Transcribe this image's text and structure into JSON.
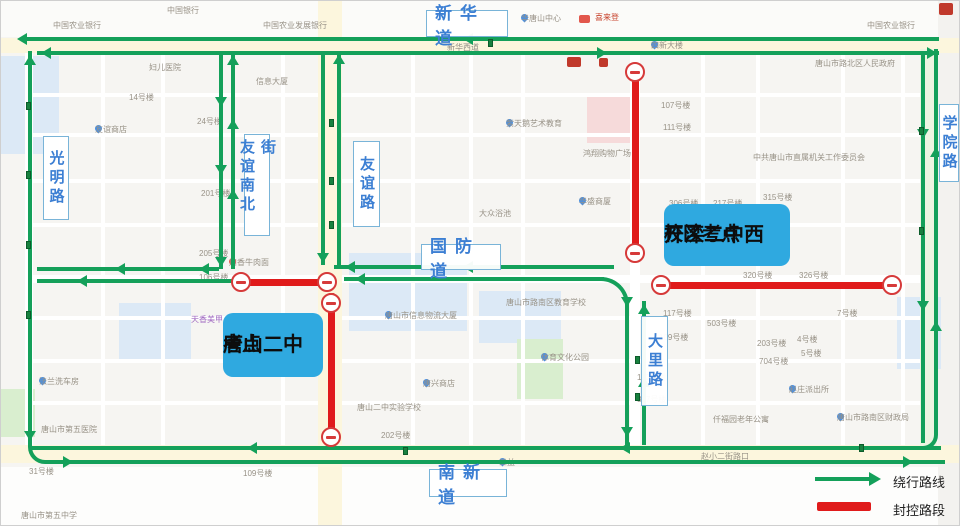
{
  "road_labels": {
    "xinhuadao": "新华道",
    "xueyuanlu": "学院路",
    "guangminglu": "光明路",
    "youyi_nanbei_jie": "友谊南北街",
    "youyilu": "友谊路",
    "guofangdao": "国防道",
    "dalilu": "大里路",
    "nanxindao": "南新道"
  },
  "exam_sites": {
    "tangshan_no2": {
      "line1": "唐山二中",
      "line2": "考点"
    },
    "kailuan_no2_west": {
      "line1": "开滦二中西",
      "line2": "校区考点"
    }
  },
  "legend": {
    "detour_label": "绕行路线",
    "closed_label": "封控路段"
  },
  "colors": {
    "detour_green": "#14a05a",
    "closed_red": "#e01b1b",
    "road_label_blue": "#3c7fd3",
    "exam_site_blue": "#2fa9e0"
  },
  "icons": {
    "no_entry_icon": "red circle with horizontal bar (road closed)",
    "detour_arrow_icon": "green directional arrow",
    "transit_stop_icon": "small green square on road",
    "poi_pin_icon": "map location pin"
  },
  "background_pois": [
    {
      "text": "中国农业银行",
      "x": 52,
      "y": 20
    },
    {
      "text": "中国银行",
      "x": 166,
      "y": 5
    },
    {
      "text": "中国农业发展银行",
      "x": 262,
      "y": 20
    },
    {
      "text": "华唐山中心",
      "x": 520,
      "y": 13,
      "pin": true
    },
    {
      "text": "喜来登",
      "x": 594,
      "y": 12,
      "color": "#c8452f"
    },
    {
      "text": "中国农业银行",
      "x": 866,
      "y": 20
    },
    {
      "text": "唐山市路北区人民政府",
      "x": 814,
      "y": 58
    },
    {
      "text": "新华西道",
      "x": 446,
      "y": 42,
      "color": "#8f8b84"
    },
    {
      "text": "四新大楼",
      "x": 650,
      "y": 40,
      "pin": true
    },
    {
      "text": "妇儿医院",
      "x": 148,
      "y": 62
    },
    {
      "text": "信息大厦",
      "x": 255,
      "y": 76
    },
    {
      "text": "友谊商店",
      "x": 94,
      "y": 124,
      "pin": true
    },
    {
      "text": "紫天鹅艺术教育",
      "x": 505,
      "y": 118,
      "pin": true
    },
    {
      "text": "鸿翔购物广场",
      "x": 582,
      "y": 148
    },
    {
      "text": "华盛商厦",
      "x": 578,
      "y": 196,
      "pin": true
    },
    {
      "text": "大众浴池",
      "x": 478,
      "y": 208
    },
    {
      "text": "中共唐山市直属机关工作委员会",
      "x": 752,
      "y": 152
    },
    {
      "text": "川香牛肉面",
      "x": 228,
      "y": 257,
      "pin": true,
      "pinColor": "#e2574c"
    },
    {
      "text": "唐山市信息物流大厦",
      "x": 384,
      "y": 310,
      "pin": true
    },
    {
      "text": "唐山市路南区教育学校",
      "x": 505,
      "y": 297
    },
    {
      "text": "天香美甲",
      "x": 190,
      "y": 314,
      "color": "#a26bc2"
    },
    {
      "text": "法兰洗车房",
      "x": 38,
      "y": 376,
      "pin": true
    },
    {
      "text": "体育文化公园",
      "x": 540,
      "y": 352,
      "pin": true
    },
    {
      "text": "唐兴商店",
      "x": 422,
      "y": 378,
      "pin": true
    },
    {
      "text": "唐山二中实验学校",
      "x": 356,
      "y": 402
    },
    {
      "text": "赵庄派出所",
      "x": 788,
      "y": 384,
      "pin": true
    },
    {
      "text": "仟福园老年公寓",
      "x": 712,
      "y": 414
    },
    {
      "text": "唐山市路南区财政局",
      "x": 836,
      "y": 412,
      "pin": true
    },
    {
      "text": "唐山市第五医院",
      "x": 40,
      "y": 424
    },
    {
      "text": "唐山市第五中学",
      "x": 20,
      "y": 510
    },
    {
      "text": "三益",
      "x": 498,
      "y": 457,
      "pin": true
    },
    {
      "text": "赵小二街路口",
      "x": 700,
      "y": 451
    },
    {
      "text": "14号楼",
      "x": 128,
      "y": 92
    },
    {
      "text": "24号楼",
      "x": 196,
      "y": 116
    },
    {
      "text": "201号楼",
      "x": 200,
      "y": 188
    },
    {
      "text": "205号楼",
      "x": 198,
      "y": 248
    },
    {
      "text": "106号楼",
      "x": 198,
      "y": 272
    },
    {
      "text": "107号楼",
      "x": 660,
      "y": 100
    },
    {
      "text": "111号楼",
      "x": 662,
      "y": 122
    },
    {
      "text": "306号楼",
      "x": 668,
      "y": 198
    },
    {
      "text": "217号楼",
      "x": 712,
      "y": 198
    },
    {
      "text": "315号楼",
      "x": 762,
      "y": 192
    },
    {
      "text": "320号楼",
      "x": 742,
      "y": 270
    },
    {
      "text": "326号楼",
      "x": 798,
      "y": 270
    },
    {
      "text": "117号楼",
      "x": 662,
      "y": 308
    },
    {
      "text": "109号楼",
      "x": 658,
      "y": 332
    },
    {
      "text": "503号楼",
      "x": 706,
      "y": 318
    },
    {
      "text": "203号楼",
      "x": 756,
      "y": 338
    },
    {
      "text": "704号楼",
      "x": 758,
      "y": 356
    },
    {
      "text": "4号楼",
      "x": 796,
      "y": 334
    },
    {
      "text": "5号楼",
      "x": 800,
      "y": 348
    },
    {
      "text": "7号楼",
      "x": 836,
      "y": 308
    },
    {
      "text": "110号楼",
      "x": 636,
      "y": 372
    },
    {
      "text": "317号楼",
      "x": 636,
      "y": 394
    },
    {
      "text": "31号楼",
      "x": 28,
      "y": 466
    },
    {
      "text": "109号楼",
      "x": 242,
      "y": 468
    },
    {
      "text": "202号楼",
      "x": 380,
      "y": 430
    }
  ]
}
